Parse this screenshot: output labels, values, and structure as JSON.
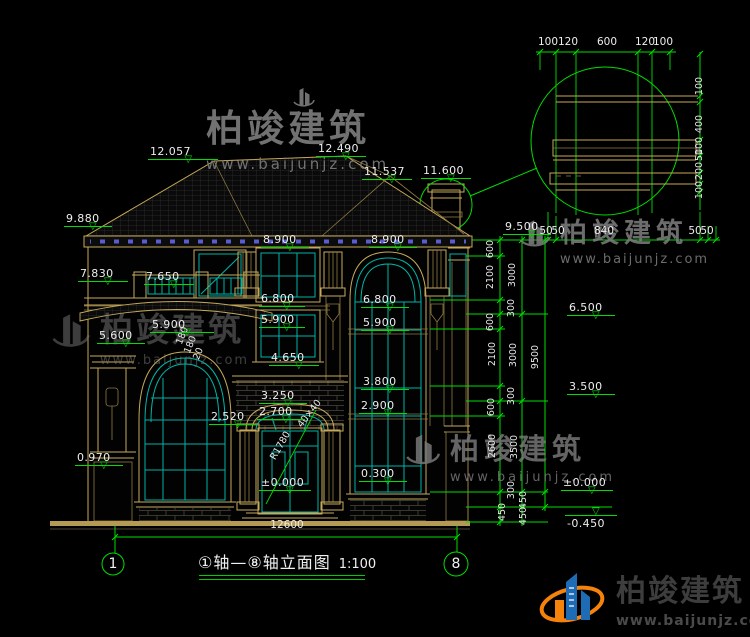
{
  "brand": {
    "name": "柏竣建筑",
    "url": "www.baijunjz.com"
  },
  "title": {
    "text": "①轴—⑧轴立面图",
    "scale": "1:100"
  },
  "axis_bubbles": [
    {
      "n": "1",
      "x": 113,
      "y": 564
    },
    {
      "n": "8",
      "x": 456,
      "y": 564
    }
  ],
  "elevation_markers": [
    {
      "v": "12.057",
      "x": 148,
      "y": 146,
      "w": 66
    },
    {
      "v": "12.490",
      "x": 316,
      "y": 143,
      "w": 46
    },
    {
      "v": "11.537",
      "x": 362,
      "y": 166,
      "w": 46
    },
    {
      "v": "11.600",
      "x": 421,
      "y": 165,
      "w": 46
    },
    {
      "v": "9.880",
      "x": 64,
      "y": 213,
      "w": 44
    },
    {
      "v": "8.900",
      "x": 261,
      "y": 234,
      "w": 44
    },
    {
      "v": "8.900",
      "x": 369,
      "y": 234,
      "w": 44
    },
    {
      "v": "7.830",
      "x": 78,
      "y": 268,
      "w": 46
    },
    {
      "v": "7.650",
      "x": 144,
      "y": 271,
      "w": 46
    },
    {
      "v": "6.800",
      "x": 259,
      "y": 293,
      "w": 42
    },
    {
      "v": "6.800",
      "x": 361,
      "y": 294,
      "w": 44
    },
    {
      "v": "5.900",
      "x": 150,
      "y": 319,
      "w": 60
    },
    {
      "v": "5.900",
      "x": 259,
      "y": 314,
      "w": 42
    },
    {
      "v": "5.900",
      "x": 361,
      "y": 317,
      "w": 44
    },
    {
      "v": "5.600",
      "x": 97,
      "y": 330,
      "w": 44
    },
    {
      "v": "4.650",
      "x": 269,
      "y": 352,
      "w": 46
    },
    {
      "v": "3.800",
      "x": 361,
      "y": 376,
      "w": 44
    },
    {
      "v": "3.250",
      "x": 259,
      "y": 390,
      "w": 44
    },
    {
      "v": "2.700",
      "x": 257,
      "y": 406,
      "w": 44
    },
    {
      "v": "2.900",
      "x": 359,
      "y": 400,
      "w": 44
    },
    {
      "v": "2.520",
      "x": 209,
      "y": 411,
      "w": 44
    },
    {
      "v": "0.970",
      "x": 75,
      "y": 452,
      "w": 44
    },
    {
      "v": "0.300",
      "x": 359,
      "y": 468,
      "w": 44
    },
    {
      "v": "±0.000",
      "x": 259,
      "y": 477,
      "w": 48
    },
    {
      "v": "9.500",
      "x": 503,
      "y": 221,
      "w": 44
    },
    {
      "v": "6.500",
      "x": 567,
      "y": 302,
      "w": 44
    },
    {
      "v": "3.500",
      "x": 567,
      "y": 381,
      "w": 44
    },
    {
      "v": "±0.000",
      "x": 561,
      "y": 477,
      "w": 48
    },
    {
      "v": "-0.450",
      "x": 565,
      "y": 515,
      "w": 48,
      "flip": true
    }
  ],
  "rotated_dims": [
    {
      "v": "600",
      "x": 491,
      "y": 249
    },
    {
      "v": "2100",
      "x": 491,
      "y": 277
    },
    {
      "v": "300",
      "x": 512,
      "y": 308
    },
    {
      "v": "600",
      "x": 491,
      "y": 322
    },
    {
      "v": "2100",
      "x": 493,
      "y": 354
    },
    {
      "v": "300",
      "x": 512,
      "y": 396
    },
    {
      "v": "600",
      "x": 492,
      "y": 407
    },
    {
      "v": "2600",
      "x": 493,
      "y": 446
    },
    {
      "v": "300",
      "x": 512,
      "y": 490
    },
    {
      "v": "450",
      "x": 503,
      "y": 512
    },
    {
      "v": "450",
      "x": 524,
      "y": 500
    },
    {
      "v": "450",
      "x": 524,
      "y": 516
    },
    {
      "v": "3000",
      "x": 513,
      "y": 275
    },
    {
      "v": "3000",
      "x": 514,
      "y": 355
    },
    {
      "v": "3500",
      "x": 515,
      "y": 447
    },
    {
      "v": "9500",
      "x": 536,
      "y": 357
    },
    {
      "v": "100",
      "x": 700,
      "y": 86
    },
    {
      "v": "400",
      "x": 700,
      "y": 124
    },
    {
      "v": "100",
      "x": 700,
      "y": 146
    },
    {
      "v": "50",
      "x": 700,
      "y": 155
    },
    {
      "v": "200",
      "x": 700,
      "y": 171
    },
    {
      "v": "100",
      "x": 700,
      "y": 190
    },
    {
      "v": "180",
      "x": 183,
      "y": 336,
      "rot": -68
    },
    {
      "v": "180",
      "x": 191,
      "y": 345,
      "rot": -68
    },
    {
      "v": "20",
      "x": 199,
      "y": 354,
      "rot": -68
    },
    {
      "v": "R1780",
      "x": 281,
      "y": 446,
      "rot": -60
    },
    {
      "v": "40×40",
      "x": 310,
      "y": 414,
      "rot": -52
    }
  ],
  "h_dims": [
    {
      "v": "100",
      "x": 548,
      "y": 37
    },
    {
      "v": "120",
      "x": 568,
      "y": 37
    },
    {
      "v": "600",
      "x": 607,
      "y": 37
    },
    {
      "v": "120",
      "x": 645,
      "y": 37
    },
    {
      "v": "100",
      "x": 663,
      "y": 37
    },
    {
      "v": "50",
      "x": 546,
      "y": 226
    },
    {
      "v": "50",
      "x": 558,
      "y": 226
    },
    {
      "v": "840",
      "x": 604,
      "y": 226
    },
    {
      "v": "50",
      "x": 695,
      "y": 226
    },
    {
      "v": "50",
      "x": 707,
      "y": 226
    },
    {
      "v": "12600",
      "x": 287,
      "y": 520
    }
  ]
}
